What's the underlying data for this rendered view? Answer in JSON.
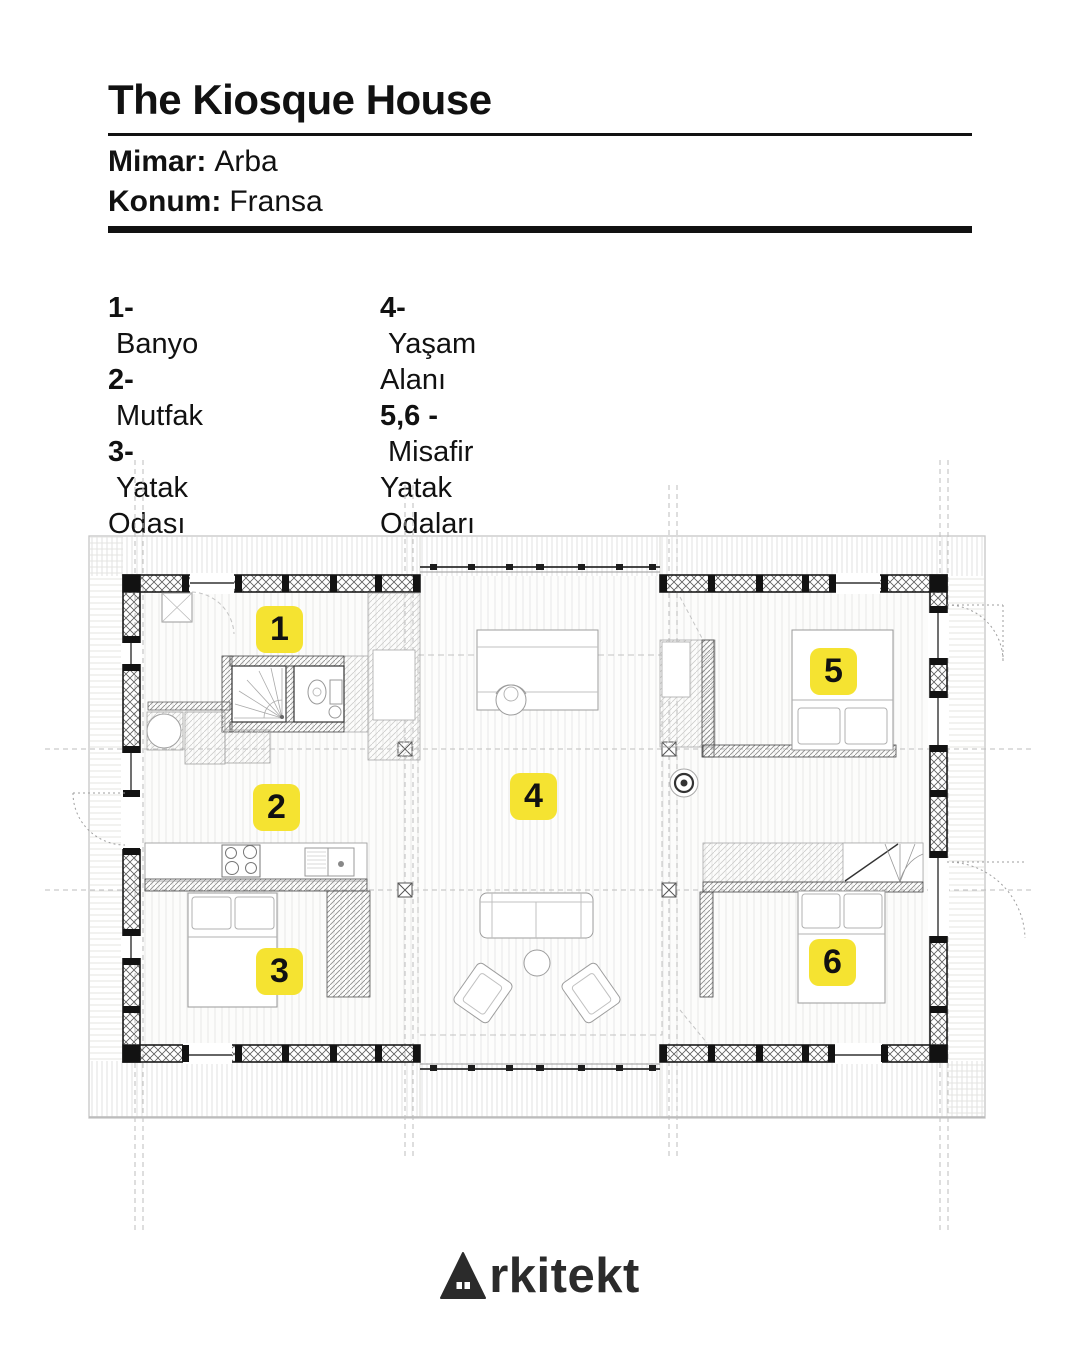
{
  "header": {
    "title": "The Kiosque House",
    "architect_label": "Mimar:",
    "architect": "Arba",
    "location_label": "Konum:",
    "location": "Fransa"
  },
  "legend": {
    "items": [
      {
        "num": "1-",
        "label": "Banyo"
      },
      {
        "num": "2-",
        "label": "Mutfak"
      },
      {
        "num": "3-",
        "label": "Yatak Odası"
      },
      {
        "num": "4-",
        "label": "Yaşam Alanı"
      },
      {
        "num": "5,6 -",
        "label": "Misafir Yatak Odaları"
      }
    ]
  },
  "plan": {
    "type": "architectural-floor-plan",
    "badge_color": "#F5E331",
    "badges": [
      "1",
      "2",
      "3",
      "4",
      "5",
      "6"
    ],
    "rooms": [
      {
        "badge": "1",
        "name": "Banyo"
      },
      {
        "badge": "2",
        "name": "Mutfak"
      },
      {
        "badge": "3",
        "name": "Yatak Odası"
      },
      {
        "badge": "4",
        "name": "Yaşam Alanı"
      },
      {
        "badge": "5",
        "name": "Misafir Yatak Odası"
      },
      {
        "badge": "6",
        "name": "Misafir Yatak Odası"
      }
    ]
  },
  "footer": {
    "logo": "Arkitekt",
    "logo_suffix": "rkitekt"
  }
}
